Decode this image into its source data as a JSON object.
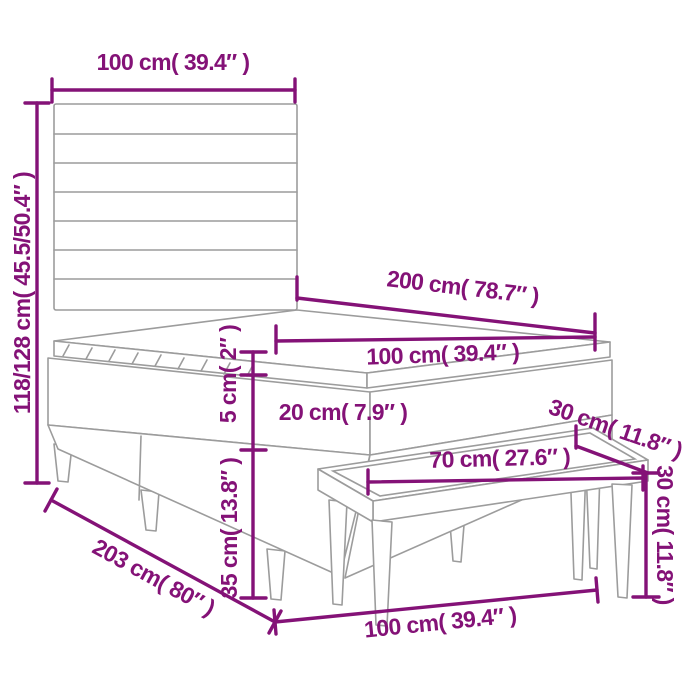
{
  "diagram": {
    "type": "product-dimension-diagram",
    "subject": "box spring bed with headboard and bench",
    "colors": {
      "dimension_accent": "#841277",
      "furniture_outline": "#9c9c9c",
      "background": "#ffffff"
    }
  },
  "labels": {
    "headboard_width": "100 cm( 39.4″ )",
    "headboard_height": "118/128 cm( 45.5/50.4″ )",
    "bed_length": "200 cm( 78.7″ )",
    "mattress_width": "100 cm( 39.4″ )",
    "topper_height": "5 cm( 2″ )",
    "mattress_height": "20 cm( 7.9″ )",
    "base_height": "35 cm( 13.8″ )",
    "bed_diagonal_length": "203 cm( 80″ )",
    "bed_width_bottom": "100 cm( 39.4″ )",
    "bench_length": "70 cm( 27.6″ )",
    "bench_depth": "30 cm( 11.8″ )",
    "bench_height": "30 cm( 11.8″ )"
  }
}
